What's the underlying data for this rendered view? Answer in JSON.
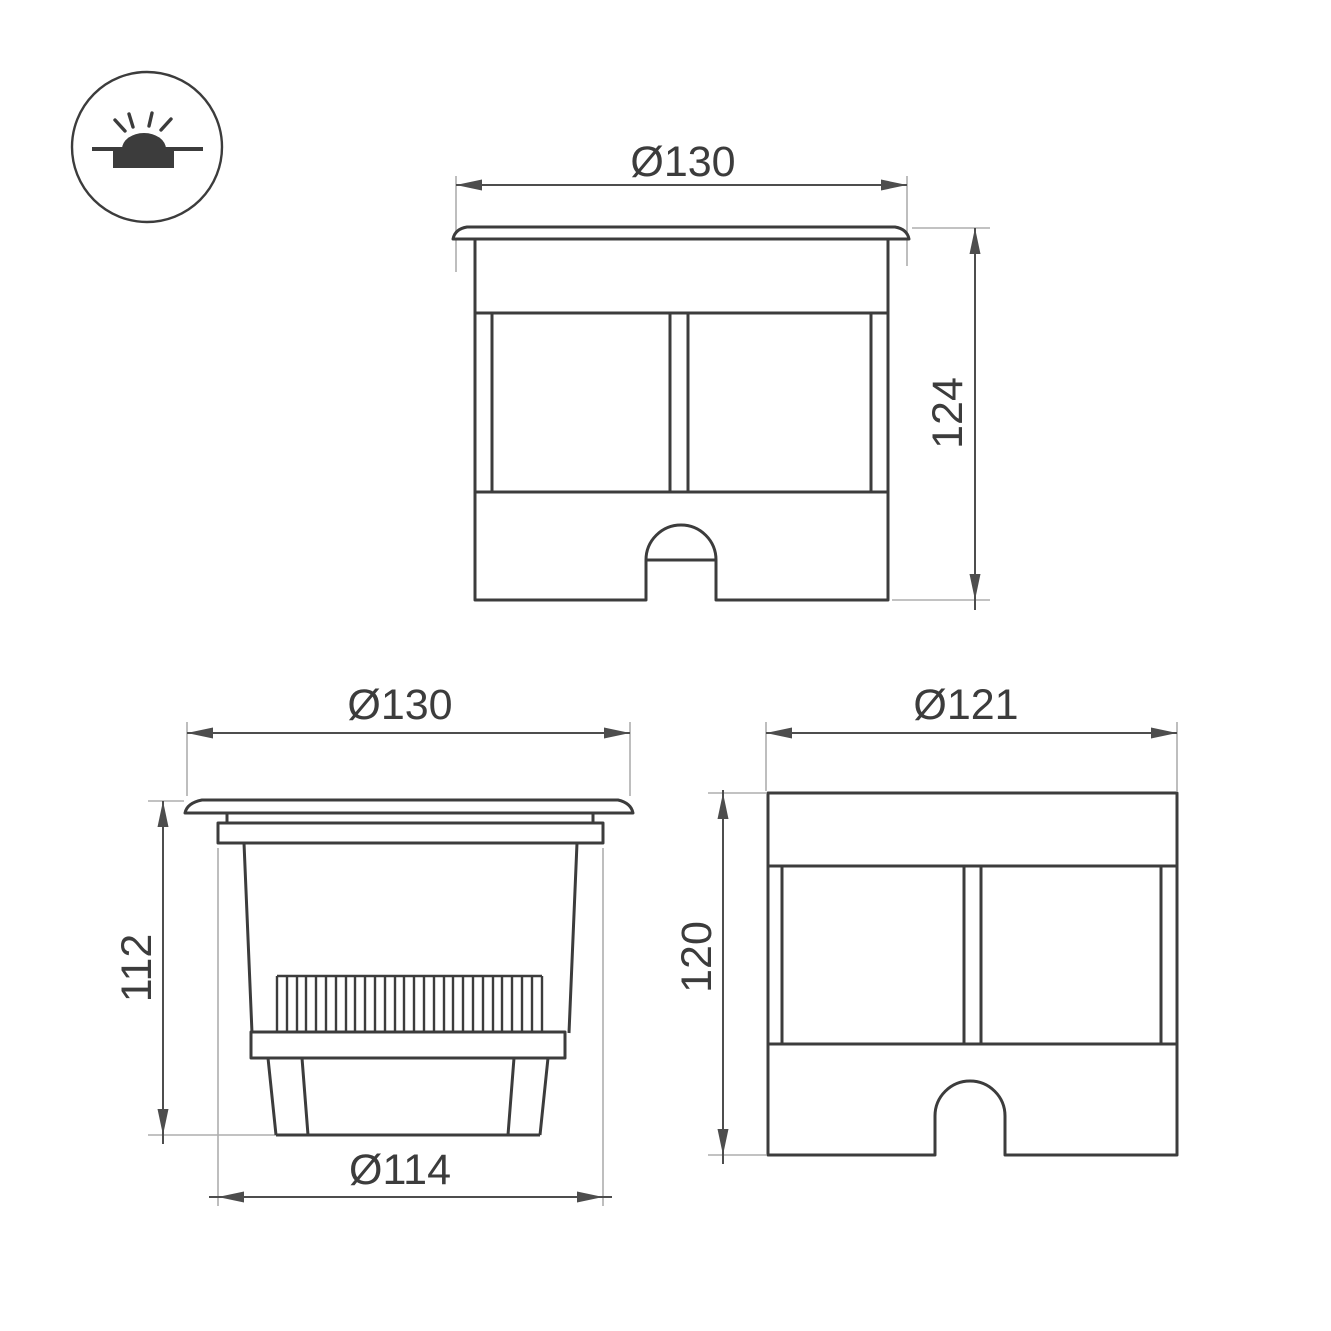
{
  "icon": {
    "type": "recessed-inground-luminaire-symbol"
  },
  "views": {
    "front": {
      "width_dim": "Ø130",
      "height_dim": "124"
    },
    "side": {
      "width_dim": "Ø130",
      "height_dim": "112",
      "bottom_dim": "Ø114"
    },
    "body": {
      "width_dim": "Ø121",
      "height_dim": "120"
    }
  },
  "colors": {
    "object_line": "#3c3c3c",
    "dimension_line": "#4d4d4d",
    "extension_line": "#aeaeae",
    "text": "#3c3c3c",
    "background": "#ffffff"
  }
}
